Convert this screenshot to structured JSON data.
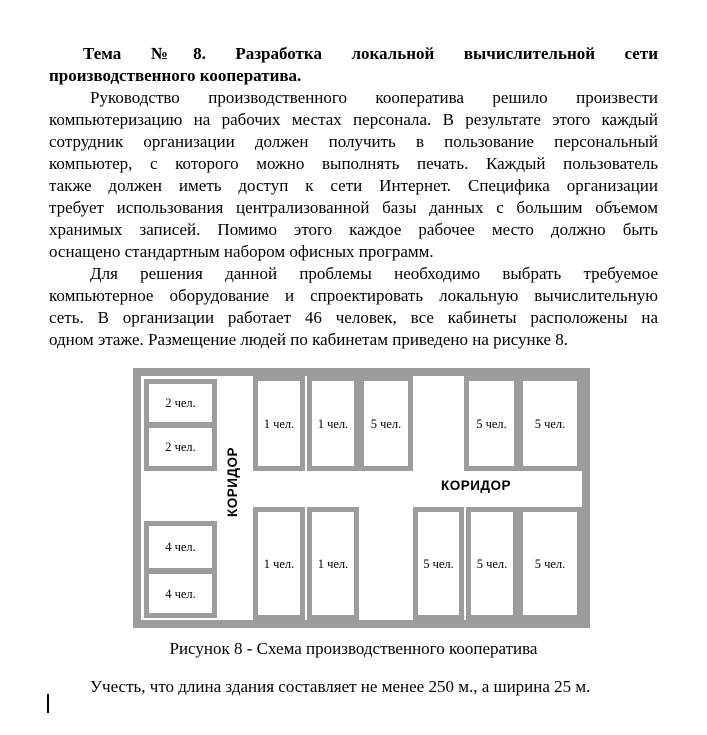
{
  "doc": {
    "title_lines": [
      "Тема №8. Разработка локальной вычислительной сети",
      "производственного кооператива."
    ],
    "p1_lines": [
      "Руководство производственного кооператива решило произвести",
      "компьютеризацию на рабочих местах персонала. В результате этого каждый",
      "сотрудник организации должен получить в пользование персональный",
      "компьютер, с которого можно выполнять печать. Каждый пользователь",
      "также должен иметь доступ к сети Интернет. Специфика организации",
      "требует использования централизованной базы данных с большим объемом",
      "хранимых записей. Помимо этого каждое рабочее место должно быть",
      "оснащено стандартным набором офисных программ."
    ],
    "p2_lines": [
      "Для решения данной проблемы необходимо выбрать требуемое",
      "компьютерное оборудование и спроектировать локальную вычислительную",
      "сеть. В организации работает 46 человек, все кабинеты расположены на",
      "одном этаже. Размещение людей по кабинетам приведено на рисунке 8."
    ],
    "note": "Учесть, что длина здания составляет не менее 250 м., а ширина 25 м."
  },
  "figure": {
    "caption": "Рисунок 8 - Схема производственного кооператива",
    "corridor_vertical": "КОРИДОР",
    "corridor_horizontal": "КОРИДОР",
    "rooms_left_top": [
      "2 чел.",
      "2 чел."
    ],
    "rooms_left_bottom": [
      "4 чел.",
      "4 чел."
    ],
    "rooms_top": [
      "1 чел.",
      "1 чел.",
      "5 чел.",
      "5 чел.",
      "5 чел."
    ],
    "rooms_bottom": [
      "1 чел.",
      "1 чел.",
      "5 чел.",
      "5 чел.",
      "5 чел."
    ]
  },
  "colors": {
    "walls": "#9c9c9c",
    "text": "#000000",
    "background": "#ffffff"
  }
}
